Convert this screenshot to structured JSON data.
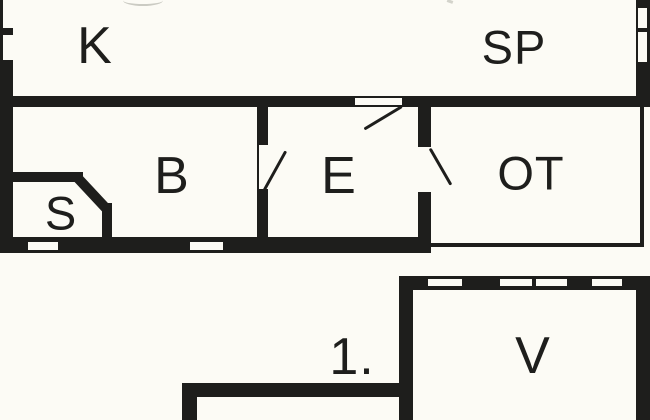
{
  "canvas": {
    "width": 650,
    "height": 420,
    "background_color": "#fcfbf5",
    "wall_color": "#1e1e1c",
    "label_color": "#1e1e1c"
  },
  "plan": {
    "type": "architectural-floor-plan",
    "upper_floor": {
      "room_labels": [
        "K",
        "SP",
        "B",
        "E",
        "OT",
        "S"
      ]
    },
    "lower_floor": {
      "floor_label": "1.",
      "room_labels": [
        "V"
      ]
    }
  }
}
